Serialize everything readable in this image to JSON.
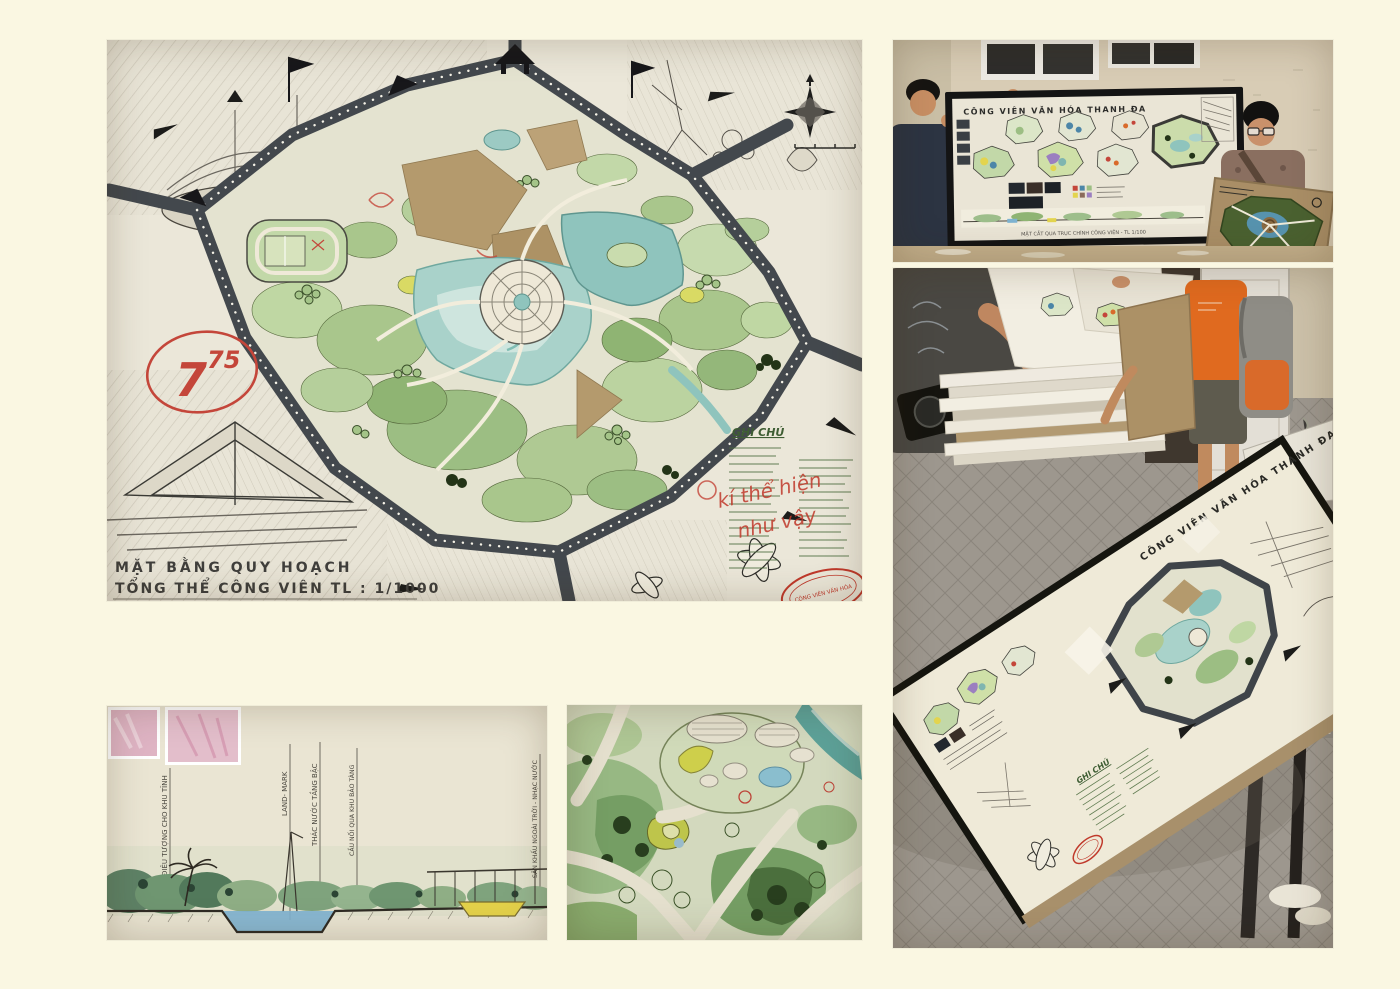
{
  "canvas": {
    "background": "#FAF7E2"
  },
  "colors": {
    "ring_road": "#43484D",
    "pond_water": "#A9D2CA",
    "foliage_green": "#9CBE83",
    "red_ink": "#C4463A",
    "kraft_paper": "#B29A72",
    "cream_paper": "#EAE5D6"
  },
  "masterplan_board": {
    "grade_main": "7",
    "grade_superscript": "75",
    "title_line1": "MẶT BẰNG QUY HOẠCH",
    "title_line2": "TỔNG THỂ CÔNG VIÊN  TL : 1/1000",
    "legend_title": "GHI CHÚ",
    "red_note_line1": "kí thể hiện",
    "red_note_line2": "như vậy",
    "stamp_text": "CÔNG VIÊN VĂN HÓA"
  },
  "presentation_photo": {
    "board_title": "CÔNG VIÊN VĂN HÓA THANH ĐA",
    "section_caption": "MẶT CẮT QUA TRỤC CHÍNH CÔNG VIÊN - TL 1/100"
  },
  "table_photo": {
    "board_title": "CÔNG VIÊN VĂN HÓA THANH ĐA",
    "legend_title": "GHI CHÚ"
  },
  "section_drawing": {
    "labels": [
      "ĐIÊU TƯỢNG CHO KHU TĨNH",
      "LAND- MARK",
      "THÁC NƯỚC TẦNG BẬC",
      "CẦU NỐI QUA KHU BẢO TÀNG",
      "SÂN KHẤU NGOÀI TRỜI - NHẠC NƯỚC"
    ]
  },
  "icons": {
    "compass": "compass-rose",
    "north_arrow": "north-arrow",
    "stamp": "red-oval-stamp"
  }
}
